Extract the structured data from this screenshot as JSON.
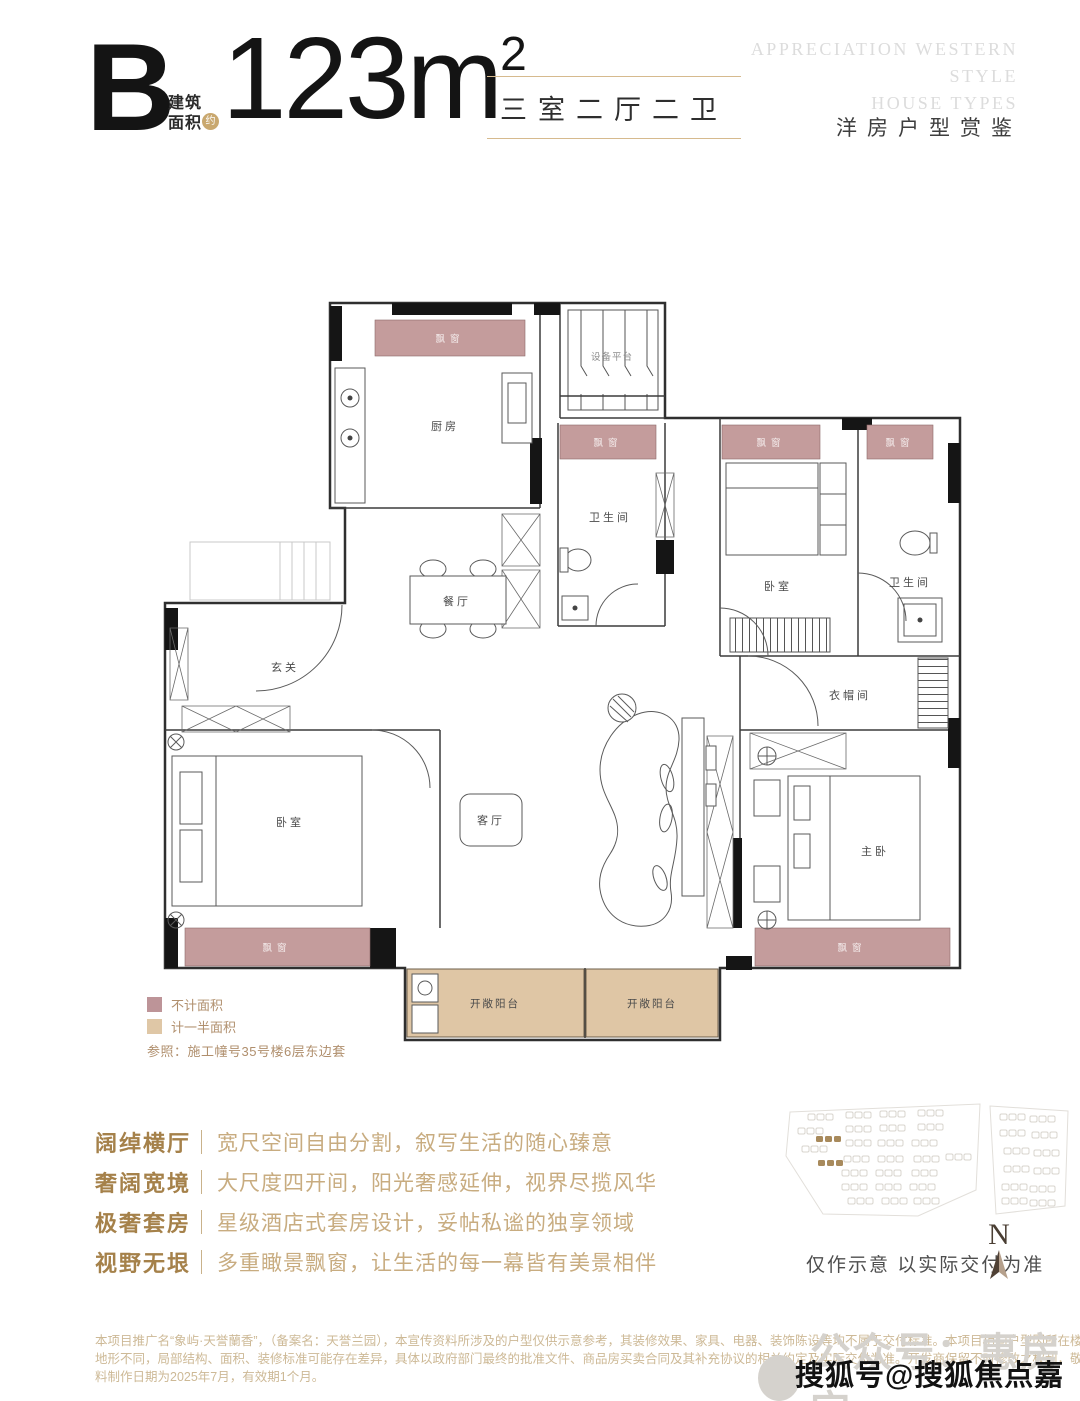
{
  "header": {
    "type_letter": "B",
    "area_caption_line1": "建筑",
    "area_caption_line2": "面积",
    "approx_badge": "约",
    "area_value": "123m",
    "area_superscript": "2",
    "layout_summary": "三室二厅二卫",
    "english_line1": "APPRECIATION WESTERN",
    "english_line2": "STYLE",
    "english_line3": "HOUSE TYPES",
    "subtitle_cn": "洋房户型赏鉴"
  },
  "floorplan": {
    "labels": {
      "kitchen": "厨房",
      "equipment_platform": "设备平台",
      "bathroom": "卫生间",
      "bedroom": "卧室",
      "dining": "餐厅",
      "foyer": "玄关",
      "cloakroom": "衣帽间",
      "living": "客厅",
      "master_bedroom": "主卧",
      "bay_window": "飘窗",
      "open_balcony": "开敞阳台"
    },
    "colors": {
      "bay_window": "#c49c9c",
      "balcony": "#dfc6a5"
    }
  },
  "legend": {
    "item1": {
      "label": "不计面积",
      "color": "#bd9498",
      "swatch_css": "background:#bd9498"
    },
    "item2": {
      "label": "计一半面积",
      "color": "#dfc7a6",
      "swatch_css": "background:#dfc7a6"
    },
    "reference": "参照：施工幢号35号楼6层东边套"
  },
  "features": {
    "rows": [
      {
        "title": "阔绰横厅",
        "desc": "宽尺空间自由分割，叙写生活的随心臻意"
      },
      {
        "title": "奢阔宽境",
        "desc": "大尺度四开间，阳光奢感延伸，视界尽揽风华"
      },
      {
        "title": "极奢套房",
        "desc": "星级酒店式套房设计，妥帖私谧的独享领域"
      },
      {
        "title": "视野无垠",
        "desc": "多重瞰景飘窗，让生活的每一幕皆有美景相伴"
      }
    ]
  },
  "siteplan": {
    "note": "仅作示意 以实际交付为准",
    "compass_letter": "N"
  },
  "disclaimer": {
    "line1": "本项目推广名“象屿·天誉蘭香”，（备案名：天誉兰园），本宣传资料所涉及的户型仅供示意参考，其装修效果、家具、电器、装饰陈设等均不属于交付标准。本项目相同户型因所在楼栋、楼层、单元、或",
    "line2": "地形不同，局部结构、面积、装修标准可能存在差异，具体以政府部门最终的批准文件、商品房买卖合同及其补充协议的相关约定及实际交付为准。开发商保留不时修改之权利，敬请留意最新资料。本资",
    "line3": "料制作日期为2025年7月，有效期1个月。"
  },
  "watermarks": {
    "wechat": "公众号：惠房宝",
    "sohu": "搜狐号@搜狐焦点嘉峪关站"
  }
}
